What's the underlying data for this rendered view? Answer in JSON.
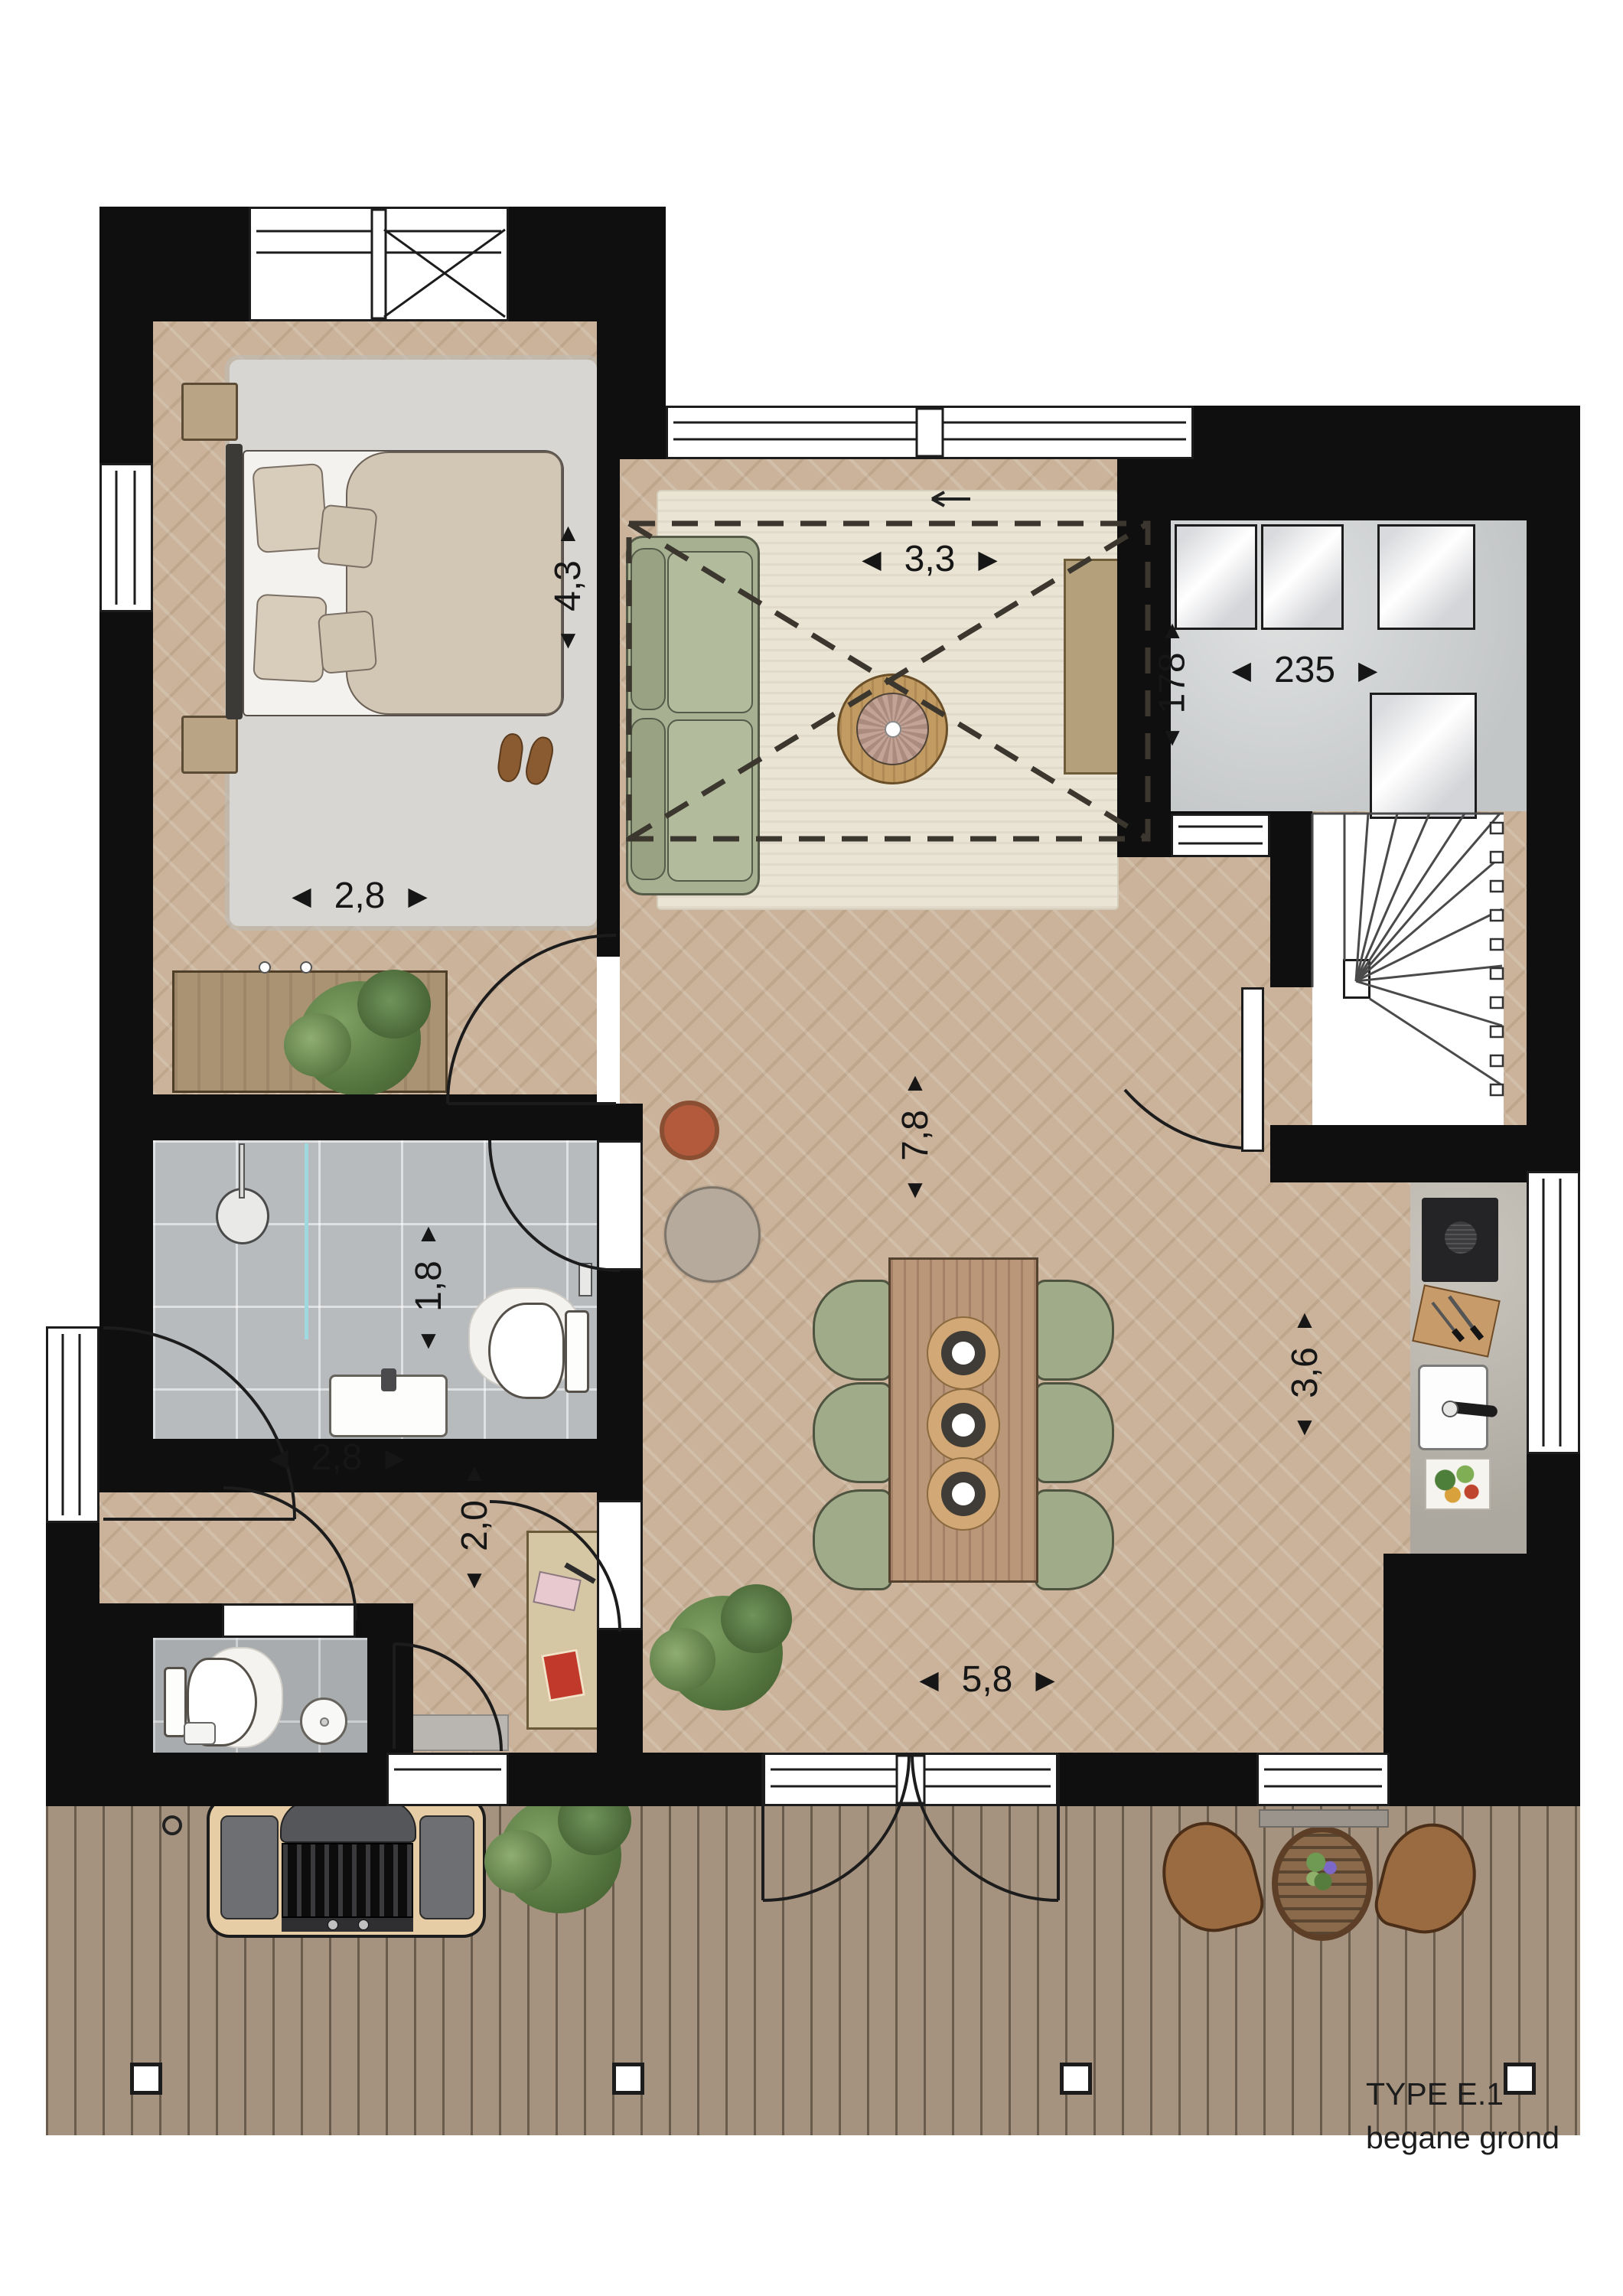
{
  "title": {
    "line1": "TYPE E.1",
    "line2": "begane grond"
  },
  "glyphs": {
    "left": "◀",
    "right": "▶",
    "up": "▲",
    "down": "▼"
  },
  "dimensions": {
    "bedroom_depth": "4,3",
    "bedroom_width": "2,8",
    "living_width": "3,3",
    "storage_width": "235",
    "storage_depth": "178",
    "bathroom_depth": "1,8",
    "hall_width": "2,8",
    "hall_depth": "2,0",
    "greatroom_depth": "7,8",
    "kitchen_depth": "3,6",
    "greatroom_width": "5,8"
  },
  "colors": {
    "wall": "#0f0f0f",
    "wood_floor": "#cab39a",
    "deck": "#a5937f",
    "tile": "#b8bbbd",
    "concrete": "#cdd0d1",
    "counter": "#b8b3a9",
    "living_rug": "#eae4d4",
    "bedroom_rug": "#d8d6d2",
    "sofa_green": "#a7b191",
    "chair_green": "#a0ac89",
    "table_wood": "#bb977a",
    "cabinet_tan": "#b4a17b",
    "glass_blue": "#9fd8de"
  }
}
